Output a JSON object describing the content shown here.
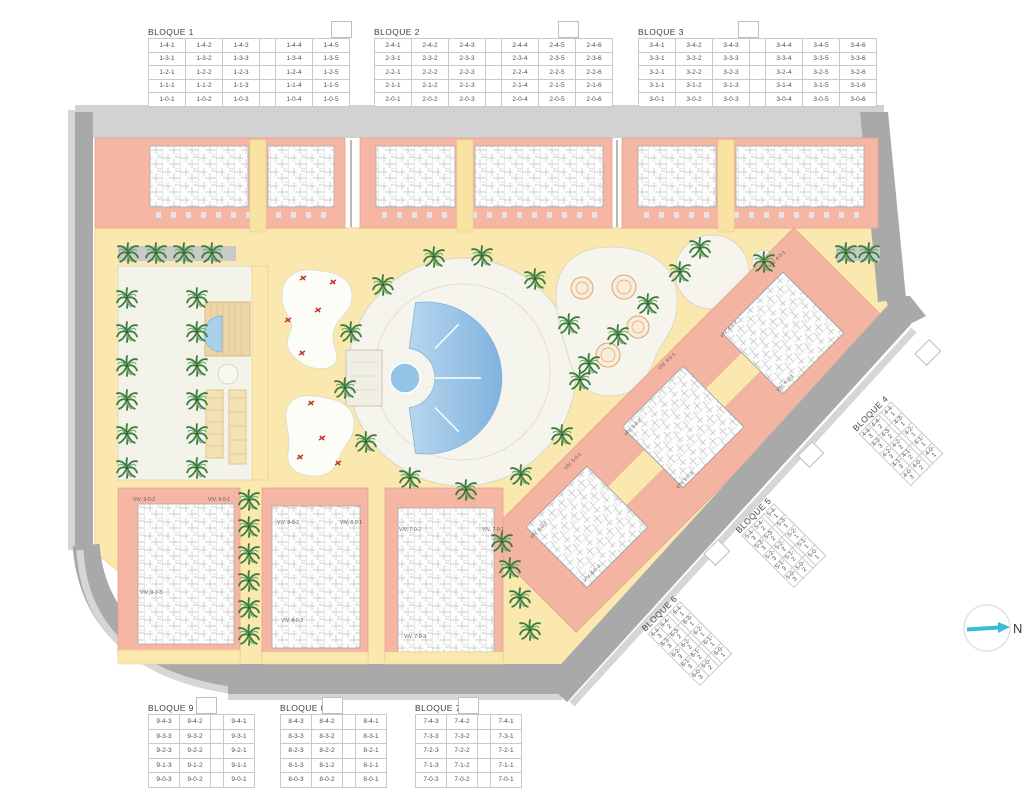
{
  "blocks": [
    {
      "title": "BLOQUE 1",
      "rows": [
        [
          "1-4-1",
          "1-4-2",
          "1-4-3",
          "",
          "1-4-4",
          "1-4-5"
        ],
        [
          "1-3-1",
          "1-3-2",
          "1-3-3",
          "",
          "1-3-4",
          "1-3-5"
        ],
        [
          "1-2-1",
          "1-2-2",
          "1-2-3",
          "",
          "1-2-4",
          "1-2-5"
        ],
        [
          "1-1-1",
          "1-1-2",
          "1-1-3",
          "",
          "1-1-4",
          "1-1-5"
        ],
        [
          "1-0-1",
          "1-0-2",
          "1-0-3",
          "",
          "1-0-4",
          "1-0-5"
        ]
      ]
    },
    {
      "title": "BLOQUE 2",
      "rows": [
        [
          "2-4-1",
          "2-4-2",
          "2-4-3",
          "",
          "2-4-4",
          "2-4-5",
          "2-4-6"
        ],
        [
          "2-3-1",
          "2-3-2",
          "2-3-3",
          "",
          "2-3-4",
          "2-3-5",
          "2-3-6"
        ],
        [
          "2-2-1",
          "2-2-2",
          "2-2-3",
          "",
          "2-2-4",
          "2-2-5",
          "2-2-6"
        ],
        [
          "2-1-1",
          "2-1-2",
          "2-1-3",
          "",
          "2-1-4",
          "2-1-5",
          "2-1-6"
        ],
        [
          "2-0-1",
          "2-0-2",
          "2-0-3",
          "",
          "2-0-4",
          "2-0-5",
          "2-0-6"
        ]
      ]
    },
    {
      "title": "BLOQUE 3",
      "rows": [
        [
          "3-4-1",
          "3-4-2",
          "3-4-3",
          "",
          "3-4-4",
          "3-4-5",
          "3-4-6"
        ],
        [
          "3-3-1",
          "3-3-2",
          "3-3-3",
          "",
          "3-3-4",
          "3-3-5",
          "3-3-6"
        ],
        [
          "3-2-1",
          "3-2-2",
          "3-2-3",
          "",
          "3-2-4",
          "3-2-5",
          "3-2-6"
        ],
        [
          "3-1-1",
          "3-1-2",
          "3-1-3",
          "",
          "3-1-4",
          "3-1-5",
          "3-1-6"
        ],
        [
          "3-0-1",
          "3-0-2",
          "3-0-3",
          "",
          "3-0-4",
          "3-0-5",
          "3-0-6"
        ]
      ]
    },
    {
      "title": "BLOQUE 4",
      "rows": [
        [
          "4-4-3",
          "4-4-2",
          "",
          "4-4-1"
        ],
        [
          "4-3-3",
          "4-3-2",
          "",
          "4-3-1"
        ],
        [
          "4-2-3",
          "4-2-2",
          "",
          "4-2-1"
        ],
        [
          "4-1-3",
          "4-1-2",
          "",
          "4-1-1"
        ],
        [
          "4-0-3",
          "4-0-2",
          "",
          "4-0-1"
        ]
      ]
    },
    {
      "title": "BLOQUE 5",
      "rows": [
        [
          "5-4-3",
          "5-4-2",
          "",
          "5-4-1"
        ],
        [
          "5-3-3",
          "5-3-2",
          "",
          "5-3-1"
        ],
        [
          "5-2-3",
          "5-2-2",
          "",
          "5-2-1"
        ],
        [
          "5-1-3",
          "5-1-2",
          "",
          "5-1-1"
        ],
        [
          "5-0-3",
          "5-0-2",
          "",
          "5-0-1"
        ]
      ]
    },
    {
      "title": "BLOQUE 6",
      "rows": [
        [
          "6-4-3",
          "6-4-2",
          "",
          "6-4-1"
        ],
        [
          "6-3-3",
          "6-3-2",
          "",
          "6-3-1"
        ],
        [
          "6-2-3",
          "6-2-2",
          "",
          "6-2-1"
        ],
        [
          "6-1-3",
          "6-1-2",
          "",
          "6-1-1"
        ],
        [
          "6-0-3",
          "6-0-2",
          "",
          "6-0-1"
        ]
      ]
    },
    {
      "title": "BLOQUE 7",
      "rows": [
        [
          "7-4-3",
          "7-4-2",
          "",
          "7-4-1"
        ],
        [
          "7-3-3",
          "7-3-2",
          "",
          "7-3-1"
        ],
        [
          "7-2-3",
          "7-2-2",
          "",
          "7-2-1"
        ],
        [
          "7-1-3",
          "7-1-2",
          "",
          "7-1-1"
        ],
        [
          "7-0-3",
          "7-0-2",
          "",
          "7-0-1"
        ]
      ]
    },
    {
      "title": "BLOQUE 8",
      "rows": [
        [
          "8-4-3",
          "8-4-2",
          "",
          "8-4-1"
        ],
        [
          "8-3-3",
          "8-3-2",
          "",
          "8-3-1"
        ],
        [
          "8-2-3",
          "8-2-2",
          "",
          "8-2-1"
        ],
        [
          "8-1-3",
          "8-1-2",
          "",
          "8-1-1"
        ],
        [
          "8-0-3",
          "8-0-2",
          "",
          "8-0-1"
        ]
      ]
    },
    {
      "title": "BLOQUE 9",
      "rows": [
        [
          "9-4-3",
          "9-4-2",
          "",
          "9-4-1"
        ],
        [
          "9-3-3",
          "9-3-2",
          "",
          "9-3-1"
        ],
        [
          "9-2-3",
          "9-2-2",
          "",
          "9-2-1"
        ],
        [
          "9-1-3",
          "9-1-2",
          "",
          "9-1-1"
        ],
        [
          "9-0-3",
          "9-0-2",
          "",
          "9-0-1"
        ]
      ]
    }
  ],
  "plan_labels": [
    {
      "text": "VIV. 4-0-1",
      "x": 770,
      "y": 268,
      "r": -45
    },
    {
      "text": "VIV. 4-0-2",
      "x": 722,
      "y": 338,
      "r": -45
    },
    {
      "text": "VIV. 4-0-1",
      "x": 660,
      "y": 370,
      "r": -45
    },
    {
      "text": "VIV. 4-0-3",
      "x": 778,
      "y": 392,
      "r": -45
    },
    {
      "text": "VIV. 5-0-2",
      "x": 626,
      "y": 436,
      "r": -45
    },
    {
      "text": "VIV. 5-0-1",
      "x": 566,
      "y": 470,
      "r": -45
    },
    {
      "text": "VIV. 5-0-3",
      "x": 678,
      "y": 489,
      "r": -45
    },
    {
      "text": "VIV. 6-0-2",
      "x": 532,
      "y": 539,
      "r": -45
    },
    {
      "text": "VIV. 6-0-3",
      "x": 585,
      "y": 582,
      "r": -45
    },
    {
      "text": "VIV. 9-0-2",
      "x": 133,
      "y": 501,
      "r": 0
    },
    {
      "text": "VIV. 9-0-1",
      "x": 208,
      "y": 501,
      "r": 0
    },
    {
      "text": "VIV. 9-0-3",
      "x": 140,
      "y": 594,
      "r": 0
    },
    {
      "text": "VIV. 8-0-2",
      "x": 277,
      "y": 524,
      "r": 0
    },
    {
      "text": "VIV. 8-0-1",
      "x": 340,
      "y": 524,
      "r": 0
    },
    {
      "text": "VIV. 8-0-3",
      "x": 281,
      "y": 622,
      "r": 0
    },
    {
      "text": "VIV. 7-0-2",
      "x": 399,
      "y": 531,
      "r": 0
    },
    {
      "text": "VIV. 7-0-1",
      "x": 482,
      "y": 531,
      "r": 0
    },
    {
      "text": "VIV. 7-0-3",
      "x": 404,
      "y": 638,
      "r": 0
    }
  ],
  "compass": {
    "label": "N"
  },
  "colors": {
    "road_light": "#d2d2d2",
    "road_dark": "#a9a9a9",
    "sidewalk": "#d6d6d6",
    "building_salmon": "#f5b7a3",
    "path_yellow": "#fbe8ae",
    "path_edge": "#ecd28c",
    "plaza_offwhite": "#f6f5ed",
    "pool_blue": "#8fc2e6",
    "pool_blue_light": "#bcd9ef",
    "palm_green": "#3e7d42",
    "play_red": "#c23b2e",
    "compass_cyan": "#3bbcd6",
    "table_border": "#c9c9c9",
    "text_gray": "#4f4f4f"
  }
}
